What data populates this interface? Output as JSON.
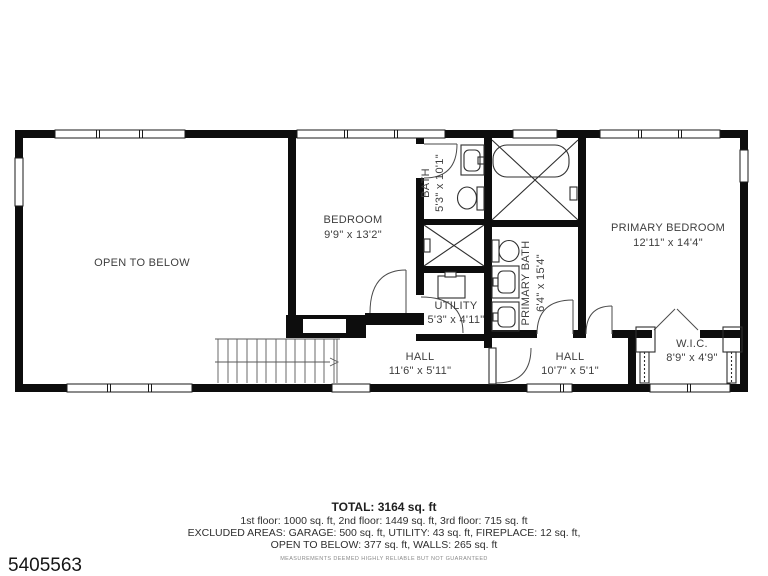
{
  "listing_id": "5405563",
  "footnote": "MEASUREMENTS DEEMED HIGHLY RELIABLE BUT NOT GUARANTEED",
  "summary": {
    "total": "TOTAL: 3164 sq. ft",
    "floors": "1st floor: 1000 sq. ft, 2nd floor: 1449 sq. ft, 3rd floor: 715 sq. ft",
    "excluded_line1": "EXCLUDED AREAS: GARAGE: 500 sq. ft, UTILITY: 43 sq. ft, FIREPLACE: 12 sq. ft,",
    "excluded_line2": "OPEN TO BELOW: 377 sq. ft, WALLS: 265 sq. ft"
  },
  "rooms": {
    "open_to_below": {
      "name": "OPEN TO BELOW"
    },
    "bedroom": {
      "name": "BEDROOM",
      "dims": "9'9\" x 13'2\""
    },
    "bath": {
      "name": "BATH",
      "dims": "5'3\" x 10'1\""
    },
    "utility": {
      "name": "UTILITY",
      "dims": "5'3\" x 4'11\""
    },
    "primary_bath": {
      "name": "PRIMARY BATH",
      "dims": "6'4\" x 15'4\""
    },
    "primary_bedroom": {
      "name": "PRIMARY BEDROOM",
      "dims": "12'11\" x 14'4\""
    },
    "hall_left": {
      "name": "HALL",
      "dims": "11'6\" x 5'11\""
    },
    "hall_right": {
      "name": "HALL",
      "dims": "10'7\" x 5'1\""
    },
    "wic": {
      "name": "W.I.C.",
      "dims": "8'9\" x 4'9\""
    }
  },
  "colors": {
    "wall": "#0d0d0d",
    "label": "#3e3e3e"
  }
}
